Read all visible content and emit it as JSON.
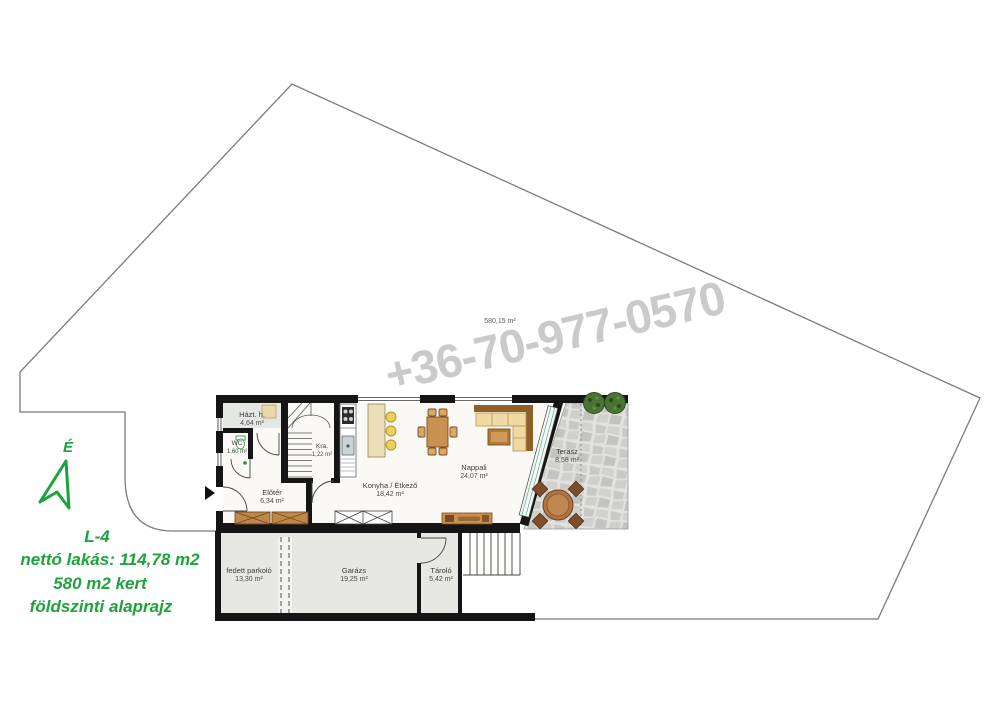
{
  "legend": {
    "north_label": "É",
    "code": "L-4",
    "net_area": "nettó lakás: 114,78 m2",
    "garden_area": "580 m2 kert",
    "floor_name": "földszinti alaprajz"
  },
  "watermark": {
    "phone": "+36-70-977-0570"
  },
  "plot": {
    "area_label": "580,15 m²"
  },
  "rooms": {
    "hazt": {
      "name": "Házt. h.",
      "area": "4,64 m²"
    },
    "wc": {
      "name": "WC",
      "area": "1,60 m²"
    },
    "kra": {
      "name": "Kra.",
      "area": "1,22 m²"
    },
    "eloter": {
      "name": "Előtér",
      "area": "6,34 m²"
    },
    "konyha": {
      "name": "Konyha / Étkező",
      "area": "18,42 m²"
    },
    "nappali": {
      "name": "Nappali",
      "area": "24,07 m²"
    },
    "terasz": {
      "name": "Terasz",
      "area": "8,58 m²"
    },
    "parkolo": {
      "name": "fedett parkoló",
      "area": "13,30 m²"
    },
    "garazs": {
      "name": "Garázs",
      "area": "19,25 m²"
    },
    "tarolo": {
      "name": "Tároló",
      "area": "5,42 m²"
    }
  },
  "colors": {
    "accent_green": "#1da33c",
    "wall_black": "#151515",
    "watermark_gray": "#b4b4b4",
    "terrace_stone": "#d8d9d5",
    "furniture_wood": "#c89051"
  }
}
